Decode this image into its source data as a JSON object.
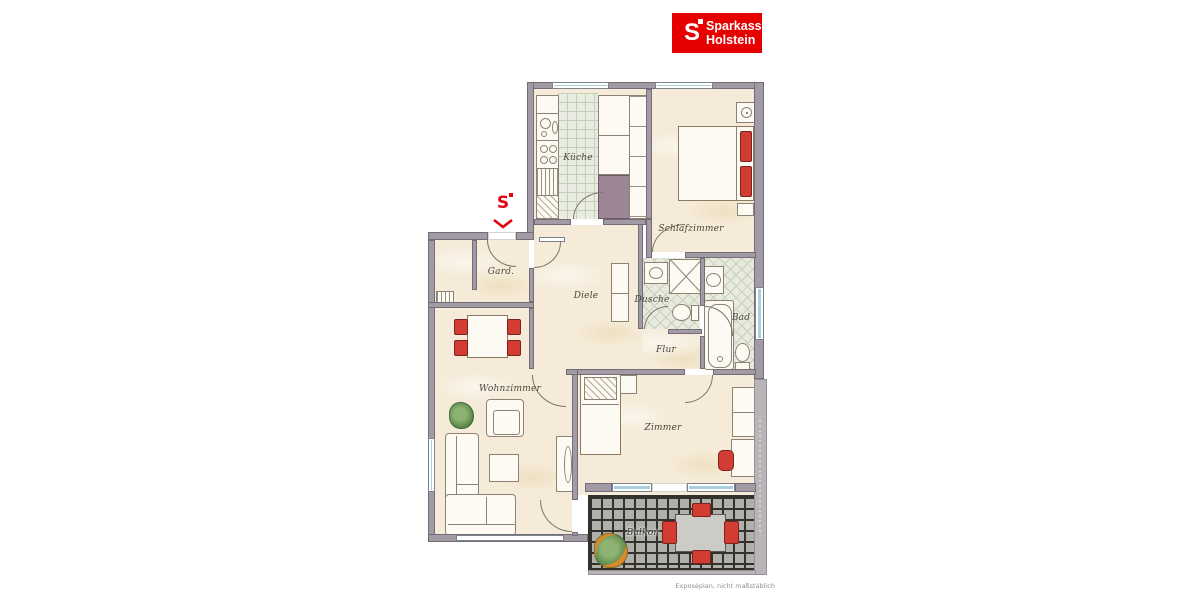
{
  "logo": {
    "symbol": "S",
    "brand": "Sparkasse",
    "region": "Holstein",
    "background_color": "#e60000",
    "text_color": "#ffffff"
  },
  "entrance_marker": {
    "symbol": "S",
    "color": "#e3000f"
  },
  "rooms": [
    {
      "id": "kueche",
      "label": "Küche"
    },
    {
      "id": "schlafzimmer",
      "label": "Schlafzimmer"
    },
    {
      "id": "gard",
      "label": "Gard."
    },
    {
      "id": "diele",
      "label": "Diele"
    },
    {
      "id": "dusche",
      "label": "Dusche"
    },
    {
      "id": "bad",
      "label": "Bad"
    },
    {
      "id": "flur",
      "label": "Flur"
    },
    {
      "id": "wohnzimmer",
      "label": "Wohnzimmer"
    },
    {
      "id": "zimmer",
      "label": "Zimmer"
    },
    {
      "id": "balkon",
      "label": "Balkon"
    }
  ],
  "footer": {
    "note": "Exposéplan, nicht maßstäblich"
  },
  "palette": {
    "wall": "#a29aa4",
    "floor": "#f5ebd8",
    "kitchen_tile": "#e9ece0",
    "bath_tile": "#e7eadd",
    "balcony_tile": "#b1afaa",
    "window": "#a9cedf",
    "accent_red": "#d23c32"
  }
}
